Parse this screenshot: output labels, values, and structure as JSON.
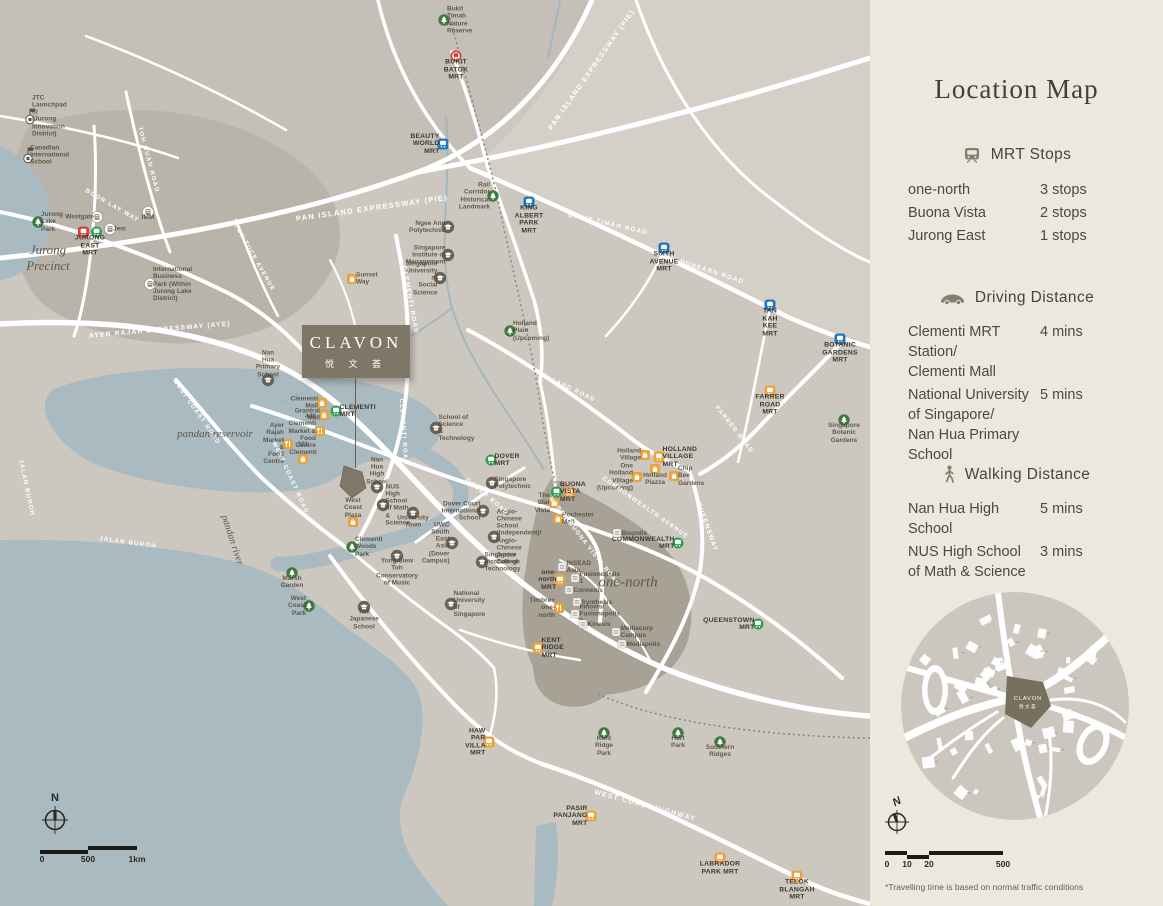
{
  "colors": {
    "map_bg": "#ccc8c0",
    "sidebar_bg": "#ebe8de",
    "water": "#a9bac1",
    "road": "#ffffff",
    "site": "#7e7666",
    "mrt_red": "#d63c3c",
    "mrt_green": "#2f9e4f",
    "mrt_blue": "#1f78bf",
    "mrt_orange": "#efa13d",
    "park_green": "#3e7a3e",
    "text_dark": "#453e32"
  },
  "sidebar": {
    "title": "Location Map",
    "sections": [
      {
        "icon": "train-icon",
        "heading": "MRT Stops",
        "rows": [
          {
            "label": "one-north",
            "value": "3 stops"
          },
          {
            "label": "Buona Vista",
            "value": "2 stops"
          },
          {
            "label": "Jurong East",
            "value": "1 stops"
          }
        ]
      },
      {
        "icon": "car-icon",
        "heading": "Driving Distance",
        "rows": [
          {
            "label": "Clementi MRT Station/\nClementi Mall",
            "value": "4 mins"
          },
          {
            "label": "National University\nof Singapore/\nNan Hua Primary School",
            "value": "5 mins"
          }
        ]
      },
      {
        "icon": "walking-icon",
        "heading": "Walking Distance",
        "rows": [
          {
            "label": "Nan Hua High School",
            "value": "5 mins"
          },
          {
            "label": "NUS High School\nof Math & Science",
            "value": "3 mins"
          }
        ]
      }
    ],
    "inset": {
      "site_name": "CLAVON",
      "site_cn": "悦文荟"
    },
    "compass_label": "N",
    "scale_ticks": [
      "0",
      "10",
      "20",
      "500"
    ],
    "footnote": "*Travelling time is based on normal traffic conditions"
  },
  "map": {
    "compass_label": "N",
    "scale_ticks": [
      "0",
      "500",
      "1km"
    ],
    "site_box": {
      "name": "CLAVON",
      "cn": "悦 文 荟"
    },
    "region_labels": [
      {
        "text": "Jurong\nPrecinct",
        "x": 48,
        "y": 258,
        "size": 13
      },
      {
        "text": "pandan reservoir",
        "x": 215,
        "y": 434,
        "size": 11
      },
      {
        "text": "pandan river",
        "x": 232,
        "y": 540,
        "size": 10,
        "rot": 72
      },
      {
        "text": "one-north",
        "x": 628,
        "y": 583,
        "size": 15
      }
    ],
    "road_labels": [
      {
        "text": "PAN ISLAND EXPRESSWAY (PIE)",
        "x": 592,
        "y": 70,
        "rot": -55,
        "size": 7
      },
      {
        "text": "PAN ISLAND EXPRESSWAY (PIE)",
        "x": 372,
        "y": 208,
        "rot": -8,
        "size": 7.5
      },
      {
        "text": "BUKIT TIMAH ROAD",
        "x": 608,
        "y": 224,
        "rot": 13,
        "size": 6.3
      },
      {
        "text": "DUNEARN ROAD",
        "x": 712,
        "y": 272,
        "rot": 18,
        "size": 6.3
      },
      {
        "text": "TOH GUAN ROAD",
        "x": 148,
        "y": 160,
        "rot": 75,
        "size": 6
      },
      {
        "text": "TOH TUCK AVENUE",
        "x": 254,
        "y": 258,
        "rot": 60,
        "size": 6
      },
      {
        "text": "BOON LAY WAY",
        "x": 112,
        "y": 206,
        "rot": 30,
        "size": 6
      },
      {
        "text": "AYER RAJAH EXPRESSWAY (AYE)",
        "x": 160,
        "y": 330,
        "rot": -5,
        "size": 6.5
      },
      {
        "text": "WEST COAST ROAD",
        "x": 196,
        "y": 412,
        "rot": 55,
        "size": 6
      },
      {
        "text": "WEST COAST ROAD",
        "x": 290,
        "y": 478,
        "rot": 65,
        "size": 6
      },
      {
        "text": "JALAN BUROH",
        "x": 128,
        "y": 543,
        "rot": 8,
        "size": 6
      },
      {
        "text": "JALAN BUROH",
        "x": 26,
        "y": 488,
        "rot": 78,
        "size": 6
      },
      {
        "text": "CLEMENTI ROAD",
        "x": 410,
        "y": 300,
        "rot": 80,
        "size": 6.3
      },
      {
        "text": "CLEMENTI ROAD",
        "x": 403,
        "y": 432,
        "rot": 86,
        "size": 6
      },
      {
        "text": "COMMONWEALTH AVENUE",
        "x": 645,
        "y": 508,
        "rot": 35,
        "size": 6
      },
      {
        "text": "NORTH BUONA VISTA ROAD",
        "x": 584,
        "y": 542,
        "rot": 52,
        "size": 6
      },
      {
        "text": "QUEENSWAY",
        "x": 707,
        "y": 527,
        "rot": 70,
        "size": 6.3
      },
      {
        "text": "FARRER ROAD",
        "x": 734,
        "y": 430,
        "rot": 52,
        "size": 6
      },
      {
        "text": "HOLLAND ROAD",
        "x": 566,
        "y": 387,
        "rot": 26,
        "size": 6
      },
      {
        "text": "DOVER ROAD",
        "x": 487,
        "y": 497,
        "rot": 40,
        "size": 6
      },
      {
        "text": "WEST COAST HIGHWAY",
        "x": 645,
        "y": 806,
        "rot": 15,
        "size": 7
      }
    ],
    "markers": [
      {
        "t": "mrt",
        "c": "red",
        "v": "ring",
        "x": 456,
        "y": 56,
        "lp": "bottom",
        "label": "BUKIT\nBATOK\nMRT"
      },
      {
        "t": "mrt2",
        "c": [
          "red",
          "green"
        ],
        "x": 90,
        "y": 232,
        "lp": "bottom",
        "label": "JURONG\nEAST\nMRT"
      },
      {
        "t": "mrt",
        "c": "blue",
        "x": 443,
        "y": 144,
        "lp": "left",
        "label": "BEAUTY\nWORLD\nMRT"
      },
      {
        "t": "mrt",
        "c": "blue",
        "x": 529,
        "y": 202,
        "lp": "bottom",
        "label": "KING\nALBERT\nPARK MRT"
      },
      {
        "t": "mrt",
        "c": "blue",
        "x": 664,
        "y": 248,
        "lp": "bottom",
        "label": "SIXTH\nAVENUE\nMRT"
      },
      {
        "t": "mrt",
        "c": "blue",
        "x": 770,
        "y": 305,
        "lp": "bottom",
        "label": "TAN KAH\nKEE MRT"
      },
      {
        "t": "mrt",
        "c": "blue",
        "x": 840,
        "y": 339,
        "lp": "bottom",
        "label": "BOTANIC\nGARDENS\nMRT"
      },
      {
        "t": "mrt",
        "c": "orange",
        "x": 770,
        "y": 391,
        "lp": "bottom",
        "label": "FARRER\nROAD\nMRT"
      },
      {
        "t": "mrt",
        "c": "green",
        "x": 336,
        "y": 411,
        "lp": "right",
        "label": "CLEMENTI\nMRT"
      },
      {
        "t": "mrt",
        "c": "green",
        "x": 491,
        "y": 460,
        "lp": "right",
        "label": "DOVER\nMRT"
      },
      {
        "t": "mrt2",
        "c": [
          "green",
          "orange"
        ],
        "x": 563,
        "y": 492,
        "lp": "right",
        "label": "BUONA\nVISTA\nMRT"
      },
      {
        "t": "mrt",
        "c": "orange",
        "x": 659,
        "y": 457,
        "lp": "right",
        "label": "HOLLAND\nVILLAGE\nMRT"
      },
      {
        "t": "mrt",
        "c": "green",
        "x": 678,
        "y": 543,
        "lp": "left",
        "label": "COMMONWEALTH\nMRT"
      },
      {
        "t": "mrt",
        "c": "green",
        "x": 758,
        "y": 624,
        "lp": "left",
        "label": "QUEENSTOWN\nMRT"
      },
      {
        "t": "mrt",
        "c": "orange",
        "x": 560,
        "y": 580,
        "lp": "left",
        "label": "one-north\nMRT"
      },
      {
        "t": "mrt",
        "c": "orange",
        "x": 538,
        "y": 648,
        "lp": "right",
        "label": "KENT\nRIDGE\nMRT"
      },
      {
        "t": "mrt",
        "c": "orange",
        "x": 489,
        "y": 742,
        "lp": "left",
        "label": "HAW PAR\nVILLA MRT"
      },
      {
        "t": "mrt",
        "c": "orange",
        "x": 591,
        "y": 816,
        "lp": "left",
        "label": "PASIR\nPANJANG\nMRT"
      },
      {
        "t": "mrt",
        "c": "orange",
        "x": 720,
        "y": 858,
        "lp": "bottom",
        "label": "LABRADOR\nPARK MRT"
      },
      {
        "t": "mrt",
        "c": "orange",
        "x": 797,
        "y": 876,
        "lp": "bottom",
        "label": "TELOK\nBLANGAH\nMRT"
      },
      {
        "t": "park",
        "x": 444,
        "y": 20,
        "lp": "right",
        "label": "Bukit Timah\nNature Reserve"
      },
      {
        "t": "park",
        "x": 38,
        "y": 222,
        "lp": "right",
        "label": "Jurong\nLake\nPark"
      },
      {
        "t": "park",
        "x": 493,
        "y": 196,
        "lp": "left",
        "label": "Rail Corridor\nHistorical\nLandmark"
      },
      {
        "t": "park",
        "x": 510,
        "y": 331,
        "lp": "right",
        "label": "Holland Plain\n(Upcoming)"
      },
      {
        "t": "park",
        "x": 844,
        "y": 420,
        "lp": "bottom",
        "label": "Singapore\nBotanic\nGardens"
      },
      {
        "t": "park",
        "x": 352,
        "y": 547,
        "lp": "right",
        "label": "Clementi\nWoods Park"
      },
      {
        "t": "park",
        "x": 292,
        "y": 573,
        "lp": "bottom",
        "label": "Marsh\nGarden"
      },
      {
        "t": "park",
        "x": 309,
        "y": 606,
        "lp": "left",
        "label": "West\nCoast Park"
      },
      {
        "t": "park",
        "x": 604,
        "y": 733,
        "lp": "bottom",
        "label": "Kent\nRidge Park"
      },
      {
        "t": "park",
        "x": 678,
        "y": 733,
        "lp": "bottom",
        "label": "Hort Park"
      },
      {
        "t": "park",
        "x": 720,
        "y": 742,
        "lp": "bottom",
        "label": "Southern\nRidges"
      },
      {
        "t": "flag",
        "x": 30,
        "y": 116,
        "lp": "right",
        "label": "JTC Launchpad @\n(Jurong Innovation District)"
      },
      {
        "t": "flag",
        "x": 28,
        "y": 155,
        "lp": "right",
        "label": "Canadian\nInternational\nSchool"
      },
      {
        "t": "school",
        "x": 448,
        "y": 227,
        "lp": "left",
        "label": "Ngee Ann\nPolytechnic"
      },
      {
        "t": "school",
        "x": 448,
        "y": 255,
        "lp": "left",
        "label": "Singapore\nInstitute of\nManagement"
      },
      {
        "t": "school",
        "x": 440,
        "y": 278,
        "lp": "left",
        "label": "Singapore\nUniversity of\nSocial Science"
      },
      {
        "t": "school",
        "x": 436,
        "y": 428,
        "lp": "right",
        "label": "School of Science\n& Technology"
      },
      {
        "t": "school",
        "x": 268,
        "y": 380,
        "lp": "top",
        "label": "Nan Hua\nPrimary\nSchool"
      },
      {
        "t": "school",
        "x": 377,
        "y": 487,
        "lp": "top",
        "label": "Nan Hua\nHigh School"
      },
      {
        "t": "school",
        "x": 383,
        "y": 505,
        "lp": "right",
        "label": "NUS High\nSchool of Math\n& Science"
      },
      {
        "t": "school",
        "x": 492,
        "y": 483,
        "lp": "right",
        "label": "Singapore\nPolytechnic"
      },
      {
        "t": "school",
        "x": 483,
        "y": 511,
        "lp": "left",
        "label": "Dover Court\nInternational\nSchool"
      },
      {
        "t": "school",
        "x": 452,
        "y": 543,
        "lp": "left",
        "label": "UWC\nSouth East Asia\n(Dover Campus)"
      },
      {
        "t": "school",
        "x": 494,
        "y": 537,
        "lp": "right",
        "label": "Anglo-Chinese School\n(Independent)/ Anglo-\nChinese Junior College"
      },
      {
        "t": "school",
        "x": 482,
        "y": 562,
        "lp": "right",
        "label": "Singapore\nInstitute of\nTechnology"
      },
      {
        "t": "school",
        "x": 413,
        "y": 513,
        "lp": "bottom",
        "label": "University\nTown"
      },
      {
        "t": "school",
        "x": 397,
        "y": 556,
        "lp": "bottom",
        "label": "Yong Siew Toh\nConservatory\nof Music"
      },
      {
        "t": "school",
        "x": 364,
        "y": 607,
        "lp": "bottom",
        "label": "The Japanese\nSchool"
      },
      {
        "t": "school",
        "x": 451,
        "y": 604,
        "lp": "right",
        "label": "National\nUniversity\nof Singapore"
      },
      {
        "t": "wbldg",
        "x": 150,
        "y": 284,
        "lp": "right",
        "label": "International\nBusiness\nPark (Within\nJurong Lake\nDistrict)"
      },
      {
        "t": "wbldg",
        "x": 148,
        "y": 212,
        "lp": "bottom",
        "label": "IMM"
      },
      {
        "t": "wbldg",
        "x": 97,
        "y": 217,
        "lp": "left",
        "label": "Westgate"
      },
      {
        "t": "wbldg",
        "x": 110,
        "y": 229,
        "lp": "right",
        "label": "Jem"
      },
      {
        "t": "mall",
        "x": 322,
        "y": 403,
        "lp": "left",
        "label": "Clementi Mall"
      },
      {
        "t": "mall",
        "x": 324,
        "y": 415,
        "lp": "left",
        "label": "Grantral Mall"
      },
      {
        "t": "mall",
        "x": 303,
        "y": 459,
        "lp": "top",
        "label": "321\nClementi"
      },
      {
        "t": "mall",
        "x": 353,
        "y": 522,
        "lp": "top",
        "label": "West Coast\nPlaza"
      },
      {
        "t": "mall",
        "x": 352,
        "y": 279,
        "lp": "right",
        "label": "Sunset Way"
      },
      {
        "t": "mall",
        "x": 645,
        "y": 455,
        "lp": "left",
        "label": "Holland\nVillage"
      },
      {
        "t": "mall",
        "x": 637,
        "y": 477,
        "lp": "left",
        "label": "One Holland\nVillage\n(Upcoming)"
      },
      {
        "t": "mall",
        "x": 655,
        "y": 469,
        "lp": "bottom",
        "label": "Holland\nPiazza"
      },
      {
        "t": "mall",
        "x": 674,
        "y": 476,
        "lp": "right",
        "label": "Chip Bee\nGardens"
      },
      {
        "t": "mall",
        "x": 554,
        "y": 503,
        "lp": "left",
        "label": "The Star\nVista"
      },
      {
        "t": "mall",
        "x": 558,
        "y": 519,
        "lp": "right",
        "label": "Rochester\nMall"
      },
      {
        "t": "food",
        "x": 320,
        "y": 431,
        "lp": "left",
        "label": "448 Clementi\nMarket & Food\nCentre"
      },
      {
        "t": "food",
        "x": 288,
        "y": 444,
        "lp": "left",
        "label": "Ayer Rajah\nMarket & Food\nCentre"
      },
      {
        "t": "food",
        "x": 559,
        "y": 608,
        "lp": "left",
        "label": "Timbre+ one-north"
      },
      {
        "t": "bldg",
        "x": 617,
        "y": 533,
        "lp": "right",
        "label": "Biopolis"
      },
      {
        "t": "bldg",
        "x": 562,
        "y": 567,
        "lp": "right",
        "label": "INSEAD Asia"
      },
      {
        "t": "bldg",
        "x": 575,
        "y": 578,
        "lp": "right",
        "label": "Fusionopolis 1"
      },
      {
        "t": "bldg",
        "x": 569,
        "y": 590,
        "lp": "right",
        "label": "Connexis"
      },
      {
        "t": "bldg",
        "x": 577,
        "y": 602,
        "lp": "right",
        "label": "Synthesis"
      },
      {
        "t": "bldg",
        "x": 575,
        "y": 614,
        "lp": "right",
        "label": "Innovis/ Fusionopolis 2"
      },
      {
        "t": "bldg",
        "x": 583,
        "y": 624,
        "lp": "right",
        "label": "Kinesis"
      },
      {
        "t": "bldg",
        "x": 616,
        "y": 632,
        "lp": "right",
        "label": "Mediacorp\nCampus"
      },
      {
        "t": "bldg",
        "x": 622,
        "y": 644,
        "lp": "right",
        "label": "Mediapolis"
      }
    ]
  }
}
